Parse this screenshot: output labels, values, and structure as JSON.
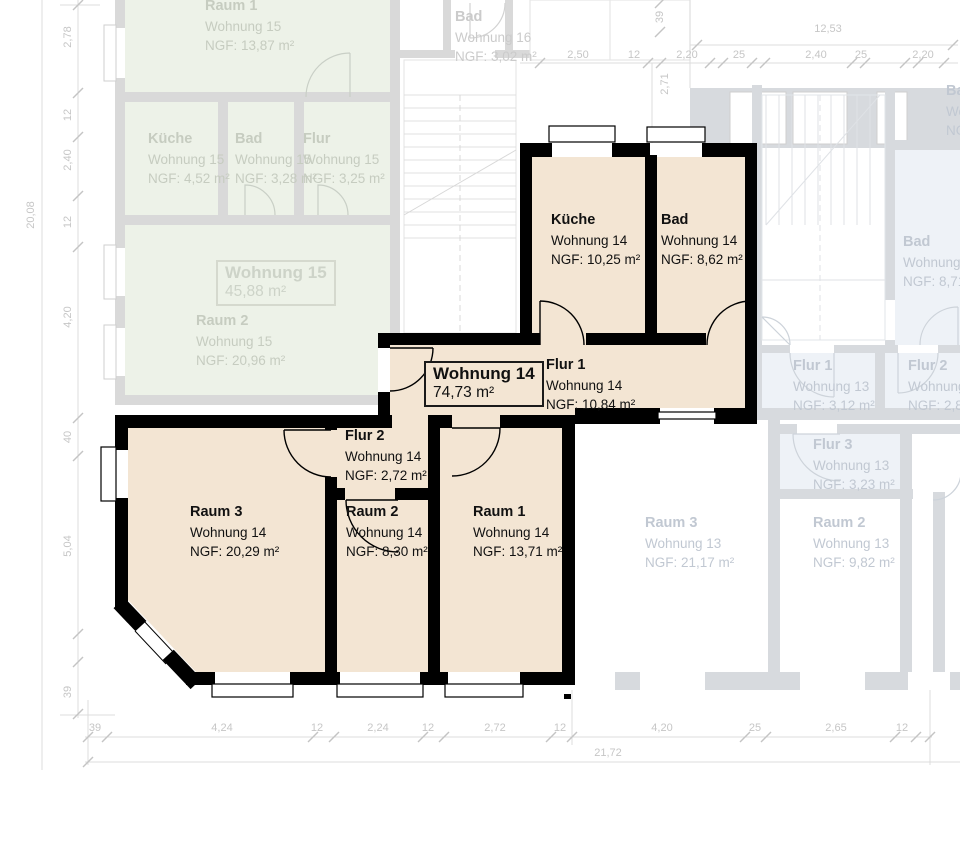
{
  "w14": {
    "box_title": "Wohnung 14",
    "box_area": "74,73 m²",
    "kueche": {
      "n": "Küche",
      "a": "Wohnung 14",
      "g": "NGF: 10,25 m²"
    },
    "bad": {
      "n": "Bad",
      "a": "Wohnung 14",
      "g": "NGF: 8,62 m²"
    },
    "flur1": {
      "n": "Flur 1",
      "a": "Wohnung 14",
      "g": "NGF: 10,84 m²"
    },
    "flur2": {
      "n": "Flur 2",
      "a": "Wohnung 14",
      "g": "NGF: 2,72 m²"
    },
    "raum1": {
      "n": "Raum 1",
      "a": "Wohnung 14",
      "g": "NGF: 13,71 m²"
    },
    "raum2": {
      "n": "Raum 2",
      "a": "Wohnung 14",
      "g": "NGF: 8,30 m²"
    },
    "raum3": {
      "n": "Raum 3",
      "a": "Wohnung 14",
      "g": "NGF: 20,29 m²"
    }
  },
  "w15": {
    "box_title": "Wohnung 15",
    "box_area": "45,88 m²",
    "raum1": {
      "n": "Raum 1",
      "a": "Wohnung 15",
      "g": "NGF: 13,87 m²"
    },
    "kueche": {
      "n": "Küche",
      "a": "Wohnung 15",
      "g": "NGF: 4,52 m²"
    },
    "bad": {
      "n": "Bad",
      "a": "Wohnung 15",
      "g": "NGF: 3,28 m²"
    },
    "flur": {
      "n": "Flur",
      "a": "Wohnung 15",
      "g": "NGF: 3,25 m²"
    },
    "raum2": {
      "n": "Raum 2",
      "a": "Wohnung 15",
      "g": "NGF: 20,96 m²"
    }
  },
  "w16": {
    "bad": {
      "n": "Bad",
      "a": "Wohnung 16",
      "g": "NGF: 3,02 m²"
    }
  },
  "w13": {
    "bad": {
      "n": "Bad",
      "a": "Wohnung 13",
      "g": "NGF: 8,71 m²"
    },
    "flur1": {
      "n": "Flur 1",
      "a": "Wohnung 13",
      "g": "NGF: 3,12 m²"
    },
    "flur2": {
      "n": "Flur 2",
      "a": "Wohnung 13",
      "g": "NGF: 2,86 m²"
    },
    "flur3": {
      "n": "Flur 3",
      "a": "Wohnung 13",
      "g": "NGF: 3,23 m²"
    },
    "raum3": {
      "n": "Raum 3",
      "a": "Wohnung 13",
      "g": "NGF: 21,17 m²"
    },
    "raum2": {
      "n": "Raum 2",
      "a": "Wohnung 13",
      "g": "NGF: 9,82 m²"
    },
    "edge": {
      "n": "Bad",
      "a": "Wohnung",
      "g": "NGF:"
    }
  },
  "dims": {
    "left_total": "20,08",
    "left": [
      "2,78",
      "12",
      "2,40",
      "12",
      "4,20",
      "40",
      "5,04",
      "39"
    ],
    "bottom": [
      "39",
      "4,24",
      "12",
      "2,24",
      "12",
      "2,72",
      "12",
      "4,20",
      "25",
      "2,65",
      "12"
    ],
    "bottom_total": "21,72",
    "top": [
      "2,50",
      "12",
      "2,20",
      "25",
      "2,40",
      "25",
      "2,20"
    ],
    "top_total": "12,53",
    "top_v1": "2,71",
    "top_v2": "39"
  }
}
